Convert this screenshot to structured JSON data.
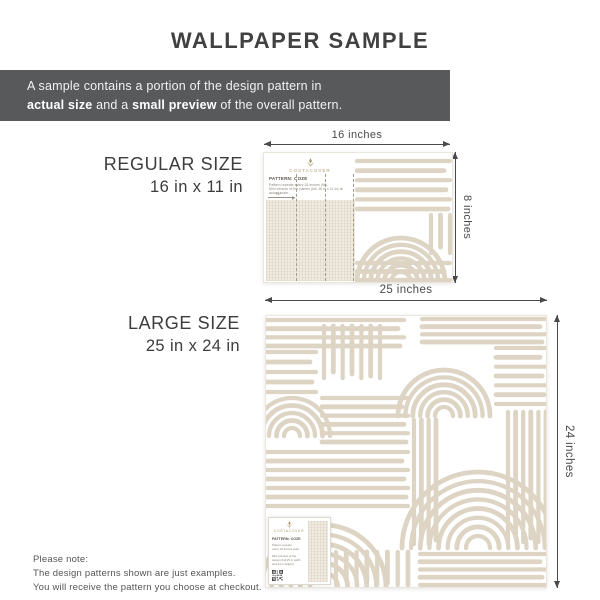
{
  "title": "WALLPAPER SAMPLE",
  "banner": {
    "line1": "A sample contains a portion of the design pattern in",
    "bold1": "actual size",
    "mid": " and a ",
    "bold2": "small preview",
    "tail": " of the overall pattern."
  },
  "regular": {
    "name": "REGULAR SIZE",
    "dimensions": "16 in x 11 in",
    "width_label": "16 inches",
    "height_label": "8 inches"
  },
  "large": {
    "name": "LARGE SIZE",
    "dimensions": "25 in x 24 in",
    "width_label": "25 inches",
    "height_label": "24 inches"
  },
  "sample_card": {
    "brand": "COSTACOVER",
    "pattern_name": "PATTERN: COZE",
    "regular_line1": "Pattern repeats every 26 inches (W).",
    "regular_line2": "Mini version of the panels (full 16 in x 11 in) at actual scale.",
    "scale_note": "26\"",
    "large_para1_l1": "Pattern repeats",
    "large_para1_l2": "every 26 inches wide.",
    "large_para2_l1": "Mini preview of the",
    "large_para2_l2": "design (full 25 in width",
    "large_para2_l3": "and 24 in height)."
  },
  "footer": {
    "line1": "Please note:",
    "line2": "The design patterns shown are just examples.",
    "line3": "You will receive the pattern you choose at checkout."
  },
  "icons": {
    "emblem": "brand-emblem-icon",
    "qr": "qr-code-icon"
  },
  "colors": {
    "accent_beige": "#ddd4c4",
    "banner_bg": "#58595b",
    "text_dark": "#3f3f3f",
    "dim_color": "#4a4a4a",
    "gold": "#b29a6e",
    "texture_bg": "#f0ebe1"
  }
}
